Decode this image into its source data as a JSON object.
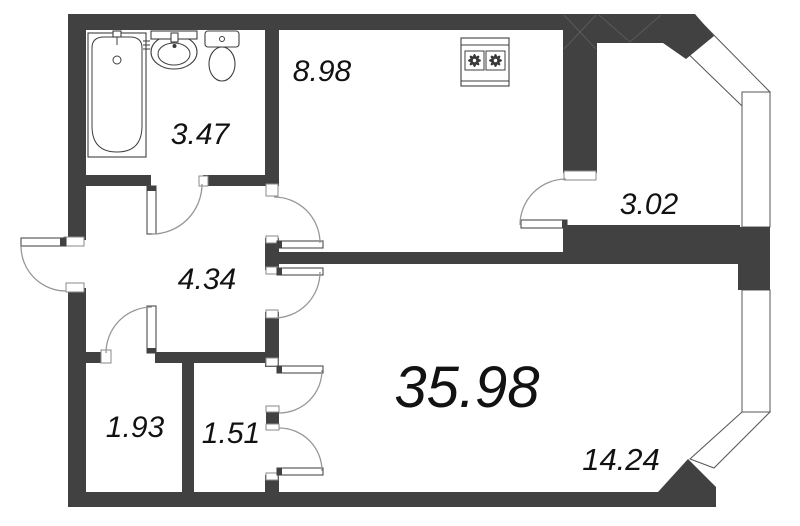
{
  "title": "Apartment floor plan",
  "colors": {
    "wall": "#414141",
    "window_outline": "#555555",
    "door_arc": "#979797",
    "text": "#121212",
    "background": "#ffffff"
  },
  "rooms": [
    {
      "id": "kitchen",
      "area": "8.98"
    },
    {
      "id": "bathroom",
      "area": "3.47"
    },
    {
      "id": "balcony",
      "area": "3.02"
    },
    {
      "id": "hallway",
      "area": "4.34"
    },
    {
      "id": "storage-left",
      "area": "1.93"
    },
    {
      "id": "storage-right",
      "area": "1.51"
    },
    {
      "id": "total",
      "area": "35.98"
    },
    {
      "id": "living-room",
      "area": "14.24"
    }
  ],
  "fixtures": [
    {
      "name": "bathtub"
    },
    {
      "name": "sink"
    },
    {
      "name": "toilet"
    },
    {
      "name": "stove"
    }
  ]
}
